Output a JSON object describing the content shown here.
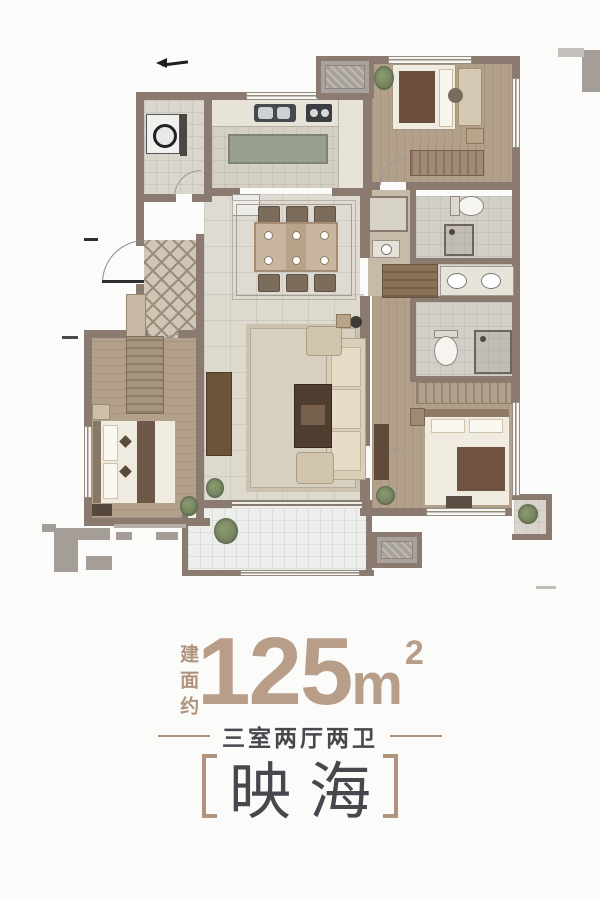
{
  "colors": {
    "wall": "#8a7a70",
    "fragment": "#a59d98",
    "accent": "#b0937d",
    "number": "#b89d89",
    "heading": "#46484d",
    "wood": "#b2a08b",
    "woodlight": "#c6bba8",
    "tile": "#e0dbd2",
    "tilecool": "#eceeeb",
    "rug": "#d7d0c0",
    "island": "#99a08e",
    "darkwood": "#5f4a39",
    "linen": "#f0ebe0",
    "blanket": "#6f5340",
    "green": "#71805d"
  },
  "floor_plan": {
    "type": "residential_floor_plan",
    "rooms": [
      "foyer",
      "kitchen",
      "utility-room",
      "dining-room",
      "living-room",
      "bedroom",
      "bedroom-2",
      "master-bedroom",
      "bathroom",
      "master-bathroom",
      "balcony",
      "equipment-platform",
      "equipment-platform-2"
    ]
  },
  "caption": {
    "area_label": "建面约",
    "area_value": "125",
    "area_unit": "m",
    "area_sup": "2",
    "layout_text": "三室两厅两卫",
    "name": "映海"
  }
}
